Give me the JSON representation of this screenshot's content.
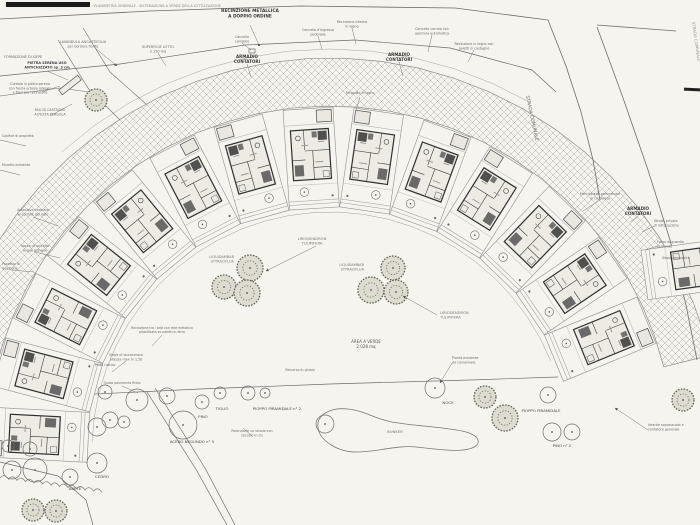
{
  "plan": {
    "type": "architectural-site-plan",
    "paper_color": "#f5f4ef",
    "ink_color": "#6d6d6d",
    "house_ink": "#2f2f2f",
    "hatch_color": "#b3b1ab",
    "title_strip_text": "PLANIMETRIA GENERALE - SISTEMAZIONE A VERDE DELLA LOTTIZZAZIONE",
    "annotations": [
      {
        "name": "fence-label",
        "lines": [
          "RECINZIONE METALLICA",
          "A DOPPIO ORDINE"
        ],
        "x": 250,
        "y": 12,
        "size": 4.3,
        "weight": 700,
        "anchor": "middle",
        "color": "#3a3a3a"
      },
      {
        "name": "road-label-strada-comunale",
        "lines": [
          "STRADA COMUNALE"
        ],
        "x": 526,
        "y": 96,
        "size": 4.6,
        "rot": 78,
        "anchor": "start",
        "color": "#6a6a6a"
      },
      {
        "name": "road-label-strada-comunale-2",
        "lines": [
          "STRADA COMUNALE"
        ],
        "x": 692,
        "y": 22,
        "size": 4,
        "rot": 82,
        "anchor": "start",
        "color": "#9a9a9a"
      },
      {
        "name": "meter-cabinet-label-1",
        "lines": [
          "ARMADIO",
          "CONTATORI"
        ],
        "x": 247,
        "y": 58,
        "size": 4.1,
        "weight": 700,
        "anchor": "middle",
        "color": "#3a3a3a"
      },
      {
        "name": "meter-cabinet-label-2",
        "lines": [
          "ARMADIO",
          "CONTATORI"
        ],
        "x": 399,
        "y": 56,
        "size": 4.1,
        "weight": 700,
        "anchor": "middle",
        "color": "#3a3a3a"
      },
      {
        "name": "meter-cabinet-label-3",
        "lines": [
          "ARMADIO",
          "CONTATORI"
        ],
        "x": 638,
        "y": 210,
        "size": 4.1,
        "weight": 700,
        "anchor": "middle",
        "color": "#3a3a3a"
      },
      {
        "name": "green-area-label",
        "lines": [
          "AREA A VERDE",
          "2.028 mq"
        ],
        "x": 366,
        "y": 343,
        "size": 4,
        "anchor": "middle",
        "color": "#5a5a5a"
      },
      {
        "name": "tree-cluster-label-1",
        "lines": [
          "LIRIODENDRON",
          "TULIPIFERA"
        ],
        "x": 312,
        "y": 240,
        "size": 3.7,
        "anchor": "middle",
        "color": "#777777"
      },
      {
        "name": "tree-cluster-label-2",
        "lines": [
          "LIRIODENDRON",
          "TULIPIFERA"
        ],
        "x": 440,
        "y": 314,
        "size": 3.7,
        "anchor": "start",
        "color": "#777777"
      },
      {
        "name": "tree-cluster-label-3",
        "lines": [
          "LIQUIDAMBAR",
          "STYRACIFLUA"
        ],
        "x": 234,
        "y": 258,
        "size": 3.5,
        "anchor": "end",
        "color": "#777777"
      },
      {
        "name": "tree-cluster-label-4",
        "lines": [
          "LIQUIDAMBAR",
          "STYRACIFLUA"
        ],
        "x": 364,
        "y": 266,
        "size": 3.5,
        "anchor": "end",
        "color": "#777777"
      },
      {
        "name": "pond-label",
        "lines": [
          "BUNKER"
        ],
        "x": 395,
        "y": 433,
        "size": 3.8,
        "anchor": "middle",
        "color": "#777777"
      },
      {
        "name": "tree-label-tiglio",
        "lines": [
          "TIGLIO"
        ],
        "x": 222,
        "y": 410,
        "size": 3.9,
        "anchor": "middle",
        "color": "#4a4a4a"
      },
      {
        "name": "tree-label-pino",
        "lines": [
          "PINO"
        ],
        "x": 203,
        "y": 418,
        "size": 3.9,
        "anchor": "middle",
        "color": "#4a4a4a"
      },
      {
        "name": "tree-label-pioppo-2",
        "lines": [
          "PIOPPO PIRAMIDALE n° 2"
        ],
        "x": 277,
        "y": 410,
        "size": 3.9,
        "anchor": "middle",
        "color": "#4a4a4a"
      },
      {
        "name": "tree-label-noce",
        "lines": [
          "NOCE"
        ],
        "x": 448,
        "y": 404,
        "size": 3.9,
        "anchor": "middle",
        "color": "#4a4a4a"
      },
      {
        "name": "tree-label-cedro",
        "lines": [
          "CEDRO"
        ],
        "x": 102,
        "y": 478,
        "size": 3.9,
        "anchor": "middle",
        "color": "#4a4a4a"
      },
      {
        "name": "tree-label-abete",
        "lines": [
          "ABETE"
        ],
        "x": 75,
        "y": 490,
        "size": 3.9,
        "anchor": "middle",
        "color": "#4a4a4a"
      },
      {
        "name": "tree-label-acero",
        "lines": [
          "ACERO NEGUNDO n° 5"
        ],
        "x": 192,
        "y": 443,
        "size": 3.9,
        "anchor": "middle",
        "color": "#4a4a4a"
      },
      {
        "name": "tree-label-pioppo",
        "lines": [
          "PIOPPO PIRAMIDALE"
        ],
        "x": 541,
        "y": 412,
        "size": 3.9,
        "anchor": "middle",
        "color": "#4a4a4a"
      },
      {
        "name": "tree-label-pino-2",
        "lines": [
          "PINO n° 2"
        ],
        "x": 562,
        "y": 447,
        "size": 3.9,
        "anchor": "middle",
        "color": "#4a4a4a"
      },
      {
        "name": "title-strip-caption",
        "lines": [
          "PLANIMETRIA GENERALE - SISTEMAZIONE A VERDE DELLA LOTTIZZAZIONE"
        ],
        "x": 94,
        "y": 7,
        "size": 3.4,
        "anchor": "start",
        "color": "#8a8a8a"
      },
      {
        "name": "ann-lavandula",
        "lines": [
          "LAVANDULA ANGUSTIFOLIA",
          "per bordure fiorite"
        ],
        "x": 83,
        "y": 43,
        "size": 3.4,
        "anchor": "middle",
        "color": "#6a6a6a"
      },
      {
        "name": "ann-siepe",
        "lines": [
          "FORMAZIONE DI SIEPE"
        ],
        "x": 4,
        "y": 58,
        "size": 3.4,
        "anchor": "start",
        "color": "#6a6a6a"
      },
      {
        "name": "ann-pietra",
        "lines": [
          "PIETRA SERENA USO",
          "ANTICHIZZATO sp. 3 cm"
        ],
        "x": 47,
        "y": 64,
        "size": 3.4,
        "weight": 600,
        "anchor": "middle",
        "color": "#444444"
      },
      {
        "name": "ann-cordolo",
        "lines": [
          "Cordolo in pietra serena",
          "con fascia erbosa laterale",
          "e filari per recinzione"
        ],
        "x": 30,
        "y": 85,
        "size": 3.3,
        "anchor": "middle",
        "color": "#6a6a6a"
      },
      {
        "name": "ann-pali",
        "lines": [
          "PALI DI CASTAGNO",
          "ALTEZZA PERGOLA"
        ],
        "x": 50,
        "y": 111,
        "size": 3.3,
        "anchor": "middle",
        "color": "#6a6a6a"
      },
      {
        "name": "ann-superficie",
        "lines": [
          "SUPERFICIE LOTTO",
          "2.150 mq"
        ],
        "x": 158,
        "y": 48,
        "size": 3.4,
        "anchor": "middle",
        "color": "#6a6a6a"
      },
      {
        "name": "ann-cancello-carrabile",
        "lines": [
          "Cancello",
          "carrabile"
        ],
        "x": 242,
        "y": 38,
        "size": 3.3,
        "anchor": "middle",
        "color": "#6a6a6a"
      },
      {
        "name": "ann-cancello-pedonale",
        "lines": [
          "Cancello d'ingresso",
          "pedonale"
        ],
        "x": 318,
        "y": 31,
        "size": 3.3,
        "anchor": "middle",
        "color": "#6a6a6a"
      },
      {
        "name": "ann-recinzione-interna",
        "lines": [
          "Recinzione interna",
          "in legno"
        ],
        "x": 352,
        "y": 23,
        "size": 3.3,
        "anchor": "middle",
        "color": "#6a6a6a"
      },
      {
        "name": "ann-cancello-carraio",
        "lines": [
          "Cancello carraio con",
          "apertura automatica"
        ],
        "x": 432,
        "y": 30,
        "size": 3.3,
        "anchor": "middle",
        "color": "#6a6a6a"
      },
      {
        "name": "ann-recinzione-legno",
        "lines": [
          "Recinzione in legno con",
          "paletti in castagno"
        ],
        "x": 474,
        "y": 45,
        "size": 3.3,
        "anchor": "middle",
        "color": "#6a6a6a"
      },
      {
        "name": "ann-autoclave",
        "lines": [
          "Autoclave interrata",
          "al confine del lotto"
        ],
        "x": 33,
        "y": 211,
        "size": 3.3,
        "anchor": "middle",
        "color": "#6a6a6a"
      },
      {
        "name": "ann-vasca",
        "lines": [
          "Vasca di raccolta",
          "acque piovane"
        ],
        "x": 35,
        "y": 247,
        "size": 3.3,
        "anchor": "middle",
        "color": "#6a6a6a"
      },
      {
        "name": "ann-pozzetto",
        "lines": [
          "Pozzetto di",
          "ispezione"
        ],
        "x": 2,
        "y": 265,
        "size": 3.3,
        "anchor": "start",
        "color": "#6a6a6a"
      },
      {
        "name": "ann-rete-lotti",
        "lines": [
          "Recinzione tra i lotti con rete metallica",
          "plastificata su paletti in ferro"
        ],
        "x": 162,
        "y": 329,
        "size": 3.2,
        "anchor": "middle",
        "color": "#6a6a6a"
      },
      {
        "name": "ann-lauroceraso",
        "lines": [
          "Siepe di lauroceraso",
          "altezza max m 1,50"
        ],
        "x": 126,
        "y": 356,
        "size": 3.3,
        "anchor": "middle",
        "color": "#6a6a6a"
      },
      {
        "name": "ann-prato",
        "lines": [
          "Prato rustico"
        ],
        "x": 105,
        "y": 366,
        "size": 3.3,
        "anchor": "middle",
        "color": "#6a6a6a"
      },
      {
        "name": "ann-quota",
        "lines": [
          "Quota pavimento finito"
        ],
        "x": 122,
        "y": 384,
        "size": 3.2,
        "anchor": "middle",
        "color": "#6a6a6a"
      },
      {
        "name": "ann-marciapiede",
        "lines": [
          "Marciapiede perimetrale",
          "in cls lavato"
        ],
        "x": 600,
        "y": 195,
        "size": 3.3,
        "anchor": "middle",
        "color": "#6a6a6a"
      },
      {
        "name": "ann-strada-privata",
        "lines": [
          "Strada privata",
          "di lottizzazione"
        ],
        "x": 654,
        "y": 222,
        "size": 3.3,
        "anchor": "start",
        "color": "#6a6a6a"
      },
      {
        "name": "ann-fosso",
        "lines": [
          "Fosso di guardia",
          "esistente"
        ],
        "x": 657,
        "y": 243,
        "size": 3.3,
        "anchor": "start",
        "color": "#6a6a6a"
      },
      {
        "name": "ann-siepe-campestre",
        "lines": [
          "Siepe campestre"
        ],
        "x": 662,
        "y": 259,
        "size": 3.3,
        "anchor": "start",
        "color": "#6a6a6a"
      },
      {
        "name": "ann-idrante",
        "lines": [
          "Idrante soprassuolo e",
          "contatore generale"
        ],
        "x": 648,
        "y": 426,
        "size": 3.3,
        "anchor": "start",
        "color": "#6a6a6a"
      },
      {
        "name": "ann-pianta-esistente",
        "lines": [
          "Pianta esistente",
          "da conservare"
        ],
        "x": 452,
        "y": 359,
        "size": 3.3,
        "anchor": "start",
        "color": "#6a6a6a"
      },
      {
        "name": "ann-pergolato",
        "lines": [
          "Pergolato in legno"
        ],
        "x": 360,
        "y": 94,
        "size": 3.2,
        "anchor": "middle",
        "color": "#6a6a6a"
      },
      {
        "name": "ann-recinzione-strada",
        "lines": [
          "Recinzione su strada con",
          "zoccolo in cls"
        ],
        "x": 252,
        "y": 432,
        "size": 3.3,
        "anchor": "middle",
        "color": "#6a6a6a"
      },
      {
        "name": "ann-ghiaia",
        "lines": [
          "Percorso in ghiaia"
        ],
        "x": 300,
        "y": 371,
        "size": 3.3,
        "anchor": "middle",
        "color": "#6a6a6a"
      },
      {
        "name": "ann-confine",
        "lines": [
          "Confine di proprietà"
        ],
        "x": 2,
        "y": 137,
        "size": 3.2,
        "anchor": "start",
        "color": "#6a6a6a"
      },
      {
        "name": "ann-muretto",
        "lines": [
          "Muretto esistente"
        ],
        "x": 2,
        "y": 166,
        "size": 3.2,
        "anchor": "start",
        "color": "#6a6a6a"
      }
    ]
  }
}
